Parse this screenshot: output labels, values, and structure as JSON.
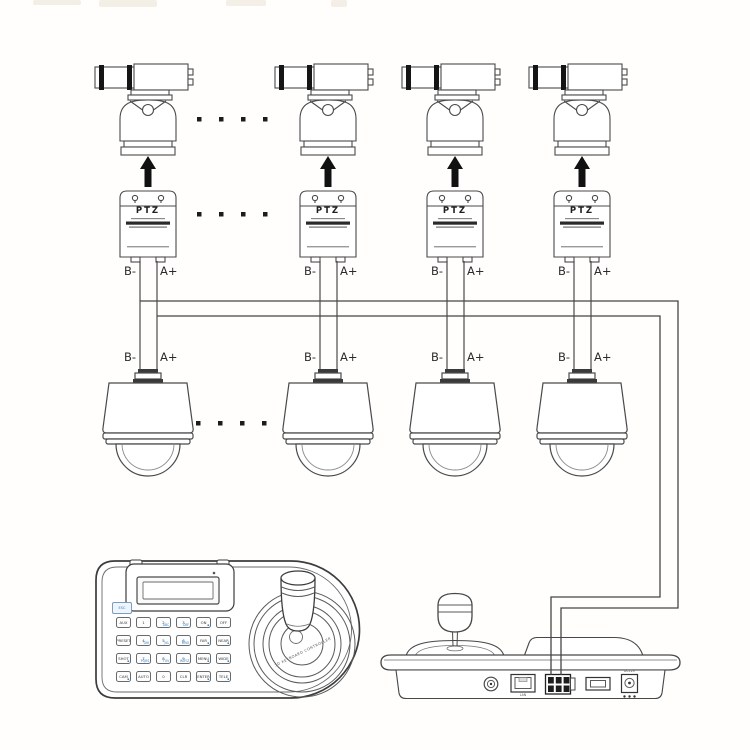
{
  "diagram": {
    "ptz_label": "PTZ",
    "wire_label_b": "B-",
    "wire_label_a": "A+"
  },
  "keyboard": {
    "esc_label": "ESC",
    "arc_text": "3D KEYBOARD CONTROLLER",
    "keys": [
      {
        "main": "AUX",
        "sub": ""
      },
      {
        "main": "1",
        "sub": ""
      },
      {
        "main": "2",
        "sub": "ABC"
      },
      {
        "main": "3",
        "sub": "DEF"
      },
      {
        "main": "ON",
        "sub": "▪"
      },
      {
        "main": "OFF",
        "sub": ""
      },
      {
        "main": "PRESET",
        "sub": ""
      },
      {
        "main": "4",
        "sub": "GHI"
      },
      {
        "main": "5",
        "sub": "JKL"
      },
      {
        "main": "6",
        "sub": "MNO"
      },
      {
        "main": "FAR",
        "sub": "▪"
      },
      {
        "main": "NEAR",
        "sub": "▪"
      },
      {
        "main": "SHOT",
        "sub": "▪"
      },
      {
        "main": "7",
        "sub": "PQRS"
      },
      {
        "main": "8",
        "sub": "TUV"
      },
      {
        "main": "9",
        "sub": "WXYZ"
      },
      {
        "main": "MENU",
        "sub": "▪"
      },
      {
        "main": "WIDE",
        "sub": "▪"
      },
      {
        "main": "CAM",
        "sub": "▪"
      },
      {
        "main": "AUTO",
        "sub": ""
      },
      {
        "main": "0",
        "sub": ""
      },
      {
        "main": "CLR",
        "sub": ""
      },
      {
        "main": "ENTER",
        "sub": "▪"
      },
      {
        "main": "TELE",
        "sub": "▪"
      }
    ]
  },
  "controller": {
    "lan_label": "LAN",
    "power_label": "DC12V"
  }
}
